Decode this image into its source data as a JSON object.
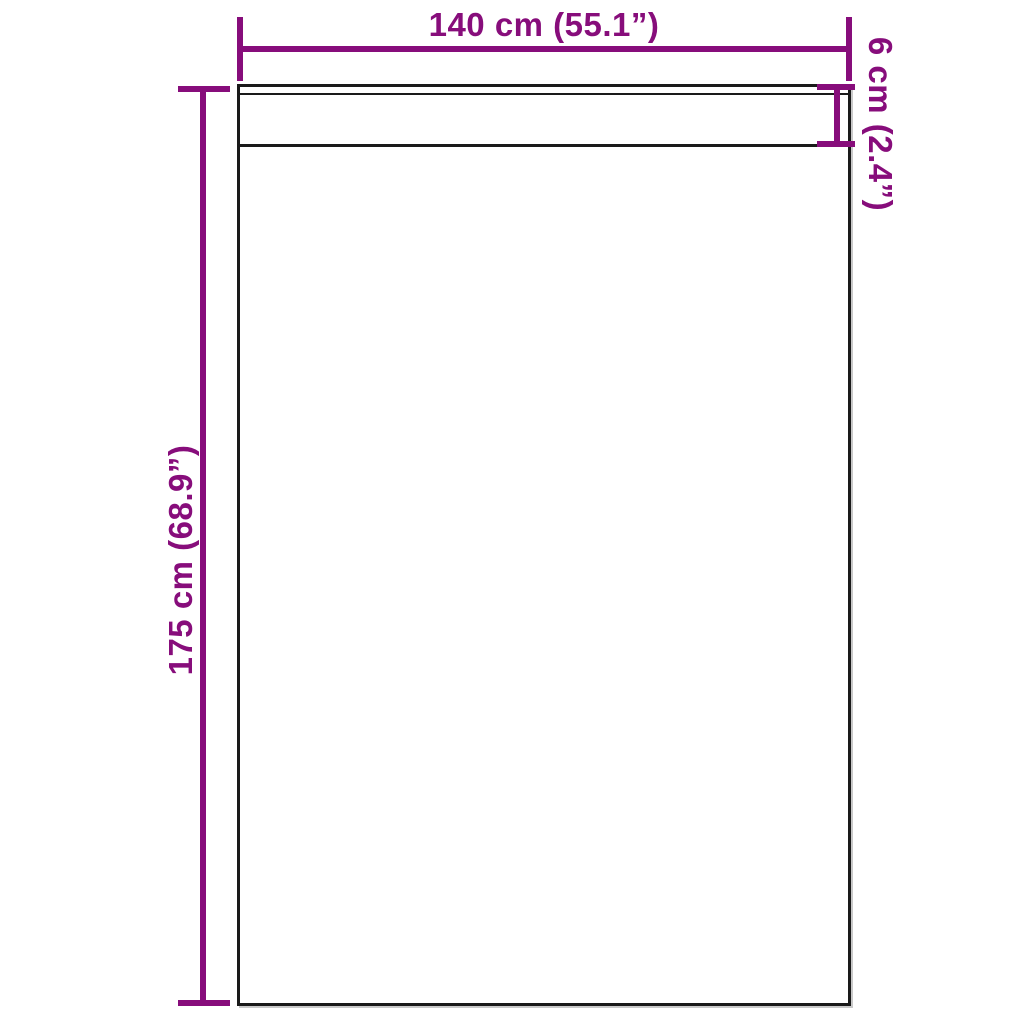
{
  "diagram": {
    "type": "product-dimension-diagram",
    "colors": {
      "accent": "#870d7b",
      "outline": "#1a1a1a",
      "background": "#ffffff",
      "shadow": "#c9c9c9"
    },
    "dimensions": {
      "width": {
        "label": "140 cm (55.1”)"
      },
      "height": {
        "label": "175 cm (68.9”)"
      },
      "hem": {
        "label": "6 cm (2.4”)"
      }
    }
  }
}
